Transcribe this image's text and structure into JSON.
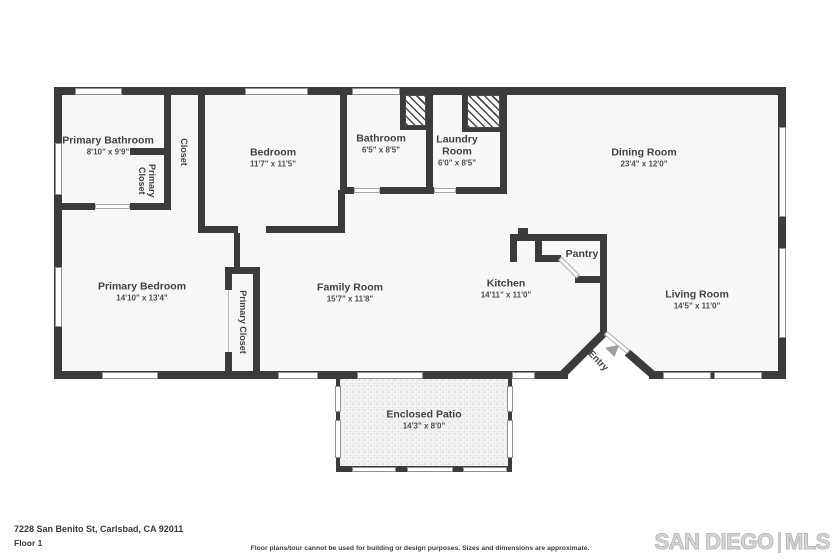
{
  "rooms": {
    "primary_bathroom": {
      "name": "Primary Bathroom",
      "dims": "8'10\" x 9'9\""
    },
    "primary_closet_small": {
      "name": "Primary Closet"
    },
    "closet": {
      "name": "Closet"
    },
    "bedroom": {
      "name": "Bedroom",
      "dims": "11'7\" x 11'5\""
    },
    "bathroom": {
      "name": "Bathroom",
      "dims": "6'5\" x 8'5\""
    },
    "laundry_room": {
      "name": "Laundry Room",
      "dims": "6'0\" x 8'5\""
    },
    "dining_room": {
      "name": "Dining Room",
      "dims": "23'4\" x 12'0\""
    },
    "primary_bedroom": {
      "name": "Primary Bedroom",
      "dims": "14'10\" x 13'4\""
    },
    "primary_closet_tall": {
      "name": "Primary Closet"
    },
    "family_room": {
      "name": "Family Room",
      "dims": "15'7\" x 11'8\""
    },
    "kitchen": {
      "name": "Kitchen",
      "dims": "14'11\" x 11'0\""
    },
    "pantry": {
      "name": "Pantry"
    },
    "living_room": {
      "name": "Living Room",
      "dims": "14'5\" x 11'0\""
    },
    "entry": {
      "name": "Entry"
    },
    "enclosed_patio": {
      "name": "Enclosed Patio",
      "dims": "14'3\" x 8'0\""
    }
  },
  "footer": {
    "address": "7228 San Benito St, Carlsbad, CA 92011",
    "floor_label": "Floor 1",
    "disclaimer": "Floor plans/tour cannot be used for building or design purposes. Sizes and dimensions are approximate.",
    "logo_primary": "SAN DIEGO",
    "logo_secondary": "MLS"
  },
  "colors": {
    "wall": "#3b3b3d",
    "logo_gray": "#c6cacc"
  }
}
